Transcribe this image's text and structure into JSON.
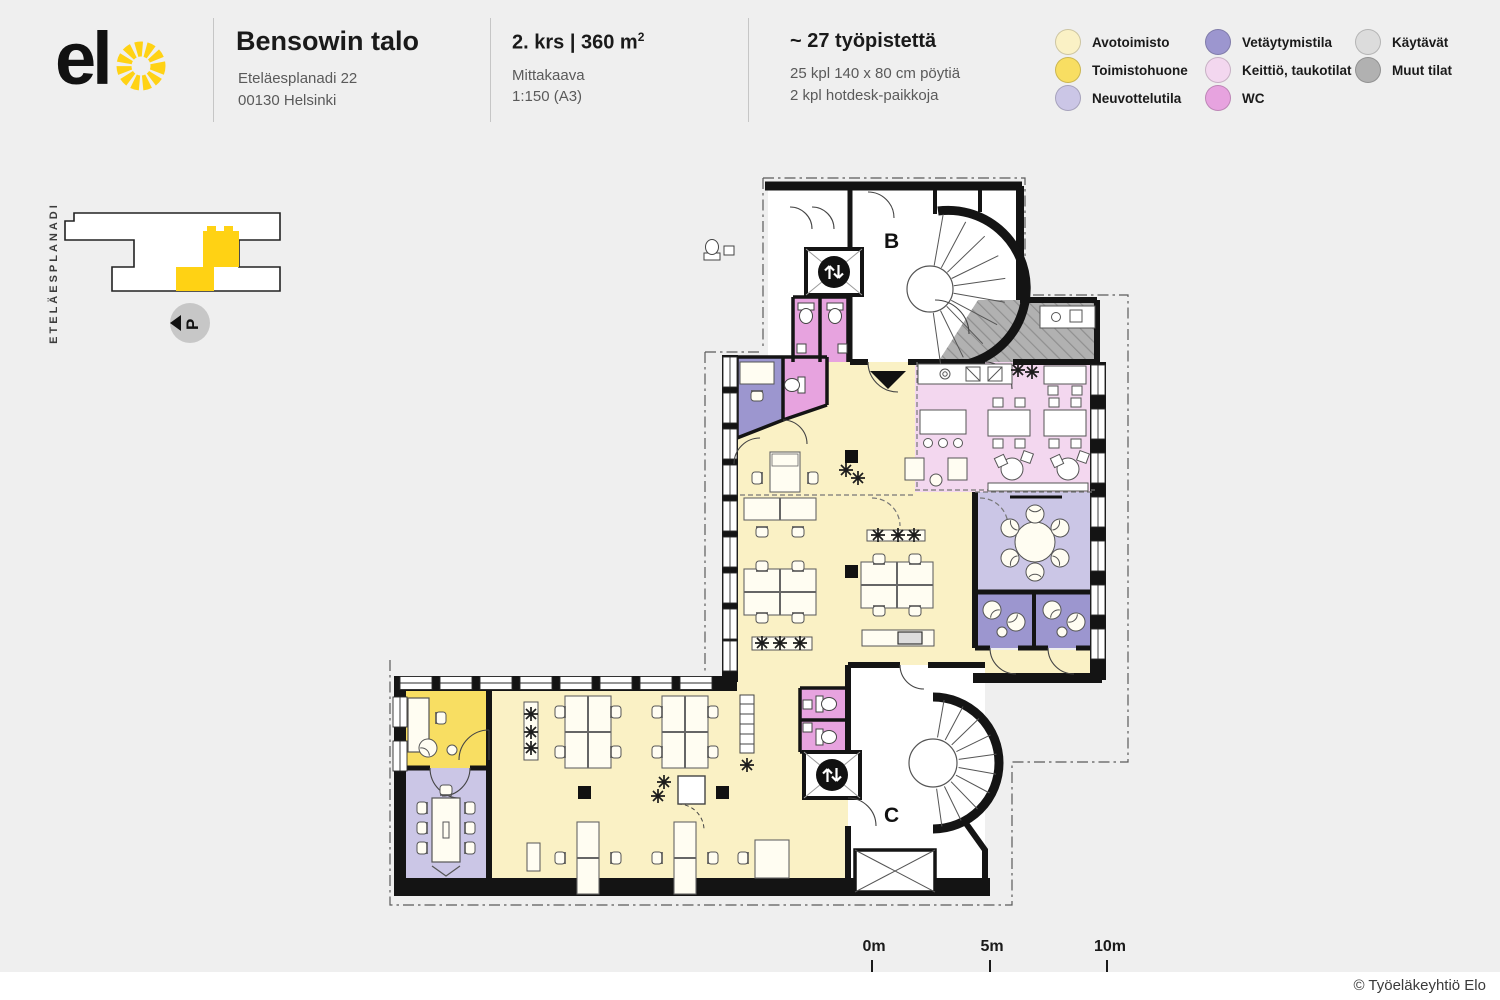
{
  "header": {
    "logo_text": "el",
    "building": "Bensowin talo",
    "address_line1": "Eteläesplanadi 22",
    "address_line2": "00130 Helsinki",
    "floor_title": "2. krs | 360 m",
    "floor_sup": "2",
    "scale_label": "Mittakaava",
    "scale_value": "1:150 (A3)",
    "workstations_title": "~ 27 työpistettä",
    "workstations_line1": "25 kpl 140 x 80 cm pöytiä",
    "workstations_line2": "2 kpl hotdesk-paikkoja"
  },
  "legend": {
    "items": [
      {
        "label": "Avotoimisto",
        "color": "#FAF1C5"
      },
      {
        "label": "Toimistohuone",
        "color": "#F8DE62"
      },
      {
        "label": "Neuvottelutila",
        "color": "#CBC6E6"
      },
      {
        "label": "Vetäytymistila",
        "color": "#9C96CF"
      },
      {
        "label": "Keittiö, taukotilat",
        "color": "#F3D7EF"
      },
      {
        "label": "WC",
        "color": "#E7A3DF"
      },
      {
        "label": "Käytävät",
        "color": "#DCDCDC"
      },
      {
        "label": "Muut tilat",
        "color": "#B1B1B1"
      }
    ]
  },
  "site_map": {
    "street_label": "ETELÄESPLANADI",
    "compass_label": "P"
  },
  "plan": {
    "stair_b_label": "B",
    "stair_c_label": "C"
  },
  "scale_bar": {
    "label_0": "0m",
    "label_5": "5m",
    "label_10": "10m"
  },
  "footer": {
    "copyright": "© Työeläkeyhtiö Elo"
  },
  "colors": {
    "avotoimisto": "#FAF1C5",
    "toimistohuone": "#F8DE62",
    "neuvottelutila": "#CBC6E6",
    "vetaytymistila": "#9C96CF",
    "keittio": "#F3D7EF",
    "wc": "#E7A3DF",
    "kaytavat": "#DCDCDC",
    "muut": "#B1B1B1",
    "elo": "#FFD214",
    "wall": "#161616"
  }
}
